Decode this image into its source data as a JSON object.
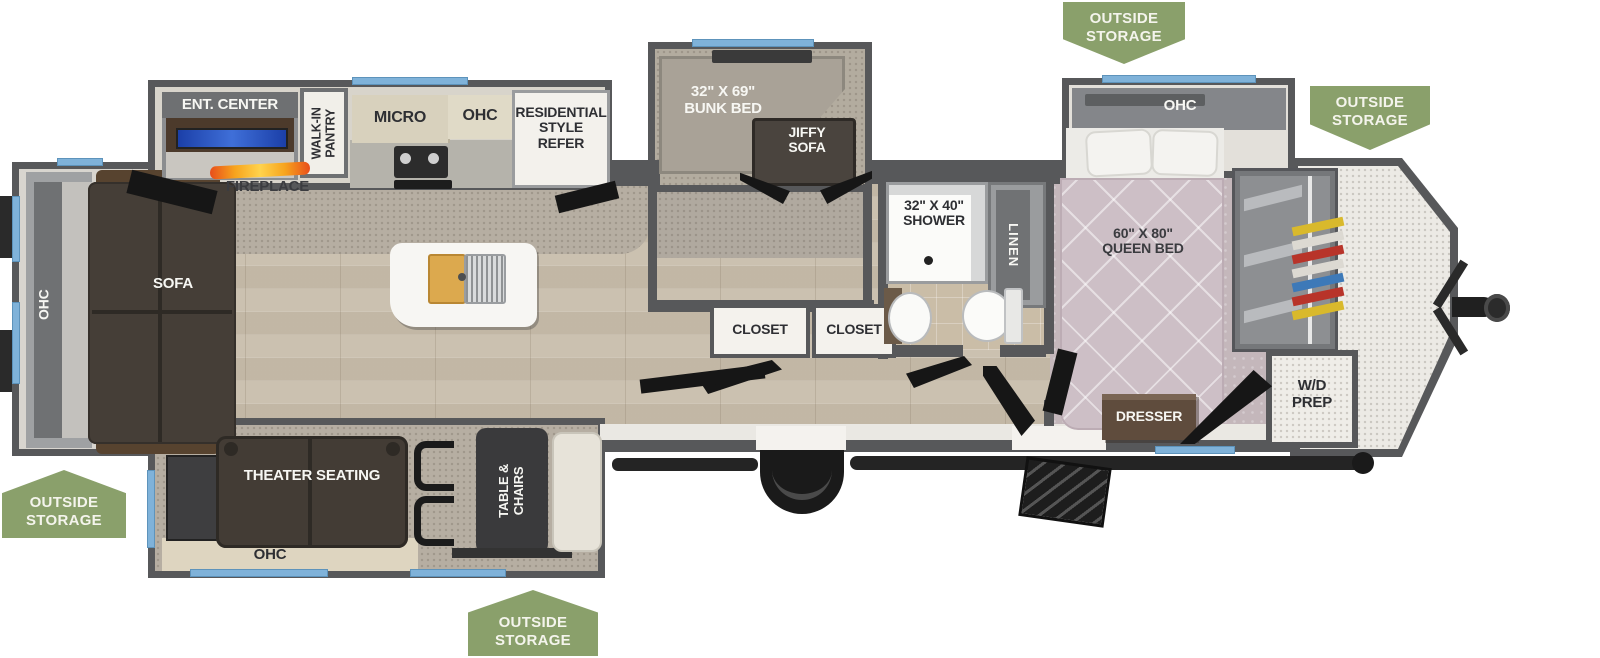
{
  "plan": {
    "type": "travel trailer floor plan",
    "badges": {
      "b1": "OUTSIDE\nSTORAGE",
      "b2": "OUTSIDE\nSTORAGE",
      "b3": "OUTSIDE\nSTORAGE",
      "b4": "OUTSIDE\nSTORAGE"
    },
    "living": {
      "ohc_rear": "OHC",
      "sofa": "SOFA",
      "ent_center": "ENT. CENTER",
      "fireplace": "FIREPLACE",
      "theater_seating": "THEATER SEATING",
      "ohc_theater": "OHC",
      "table_chairs": "TABLE &\nCHAIRS"
    },
    "kitchen": {
      "walk_in_pantry": "WALK-IN\nPANTRY",
      "micro": "MICRO",
      "ohc": "OHC",
      "refer": "RESIDENTIAL\nSTYLE\nREFER"
    },
    "bunk_room": {
      "bunk_bed": "32\" X 69\"\nBUNK BED",
      "jiffy_sofa": "JIFFY\nSOFA",
      "closet_1": "CLOSET",
      "closet_2": "CLOSET"
    },
    "bathroom": {
      "shower": "32\" X 40\"\nSHOWER",
      "linen": "LINEN"
    },
    "bedroom": {
      "ohc": "OHC",
      "queen_bed": "60\" X 80\"\nQUEEN BED",
      "dresser": "DRESSER"
    },
    "front": {
      "wd_prep": "W/D\nPREP"
    },
    "colors": {
      "badge_green": "#8aa06b",
      "wall_gray": "#57585a",
      "window_blue": "#7fb2d9",
      "wood_floor": "#cbc1b0",
      "bedroom_carpet": "#c4b7bb",
      "flame_orange": "#f47a1f"
    }
  }
}
